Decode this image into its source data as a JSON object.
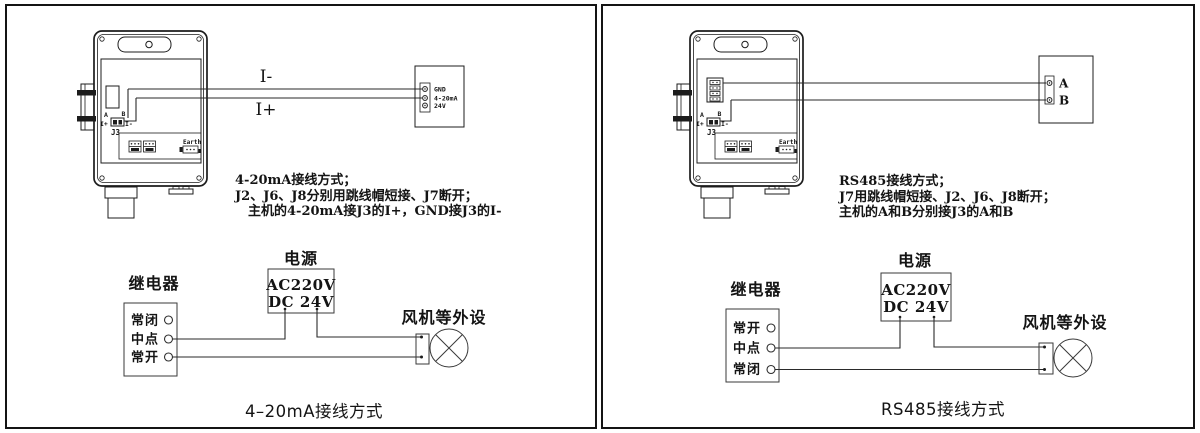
{
  "colors": {
    "line": "#1c1c1c",
    "background": "#ffffff"
  },
  "panels": [
    {
      "name": "4-20mA wiring panel",
      "device": {
        "j3_label": "J3",
        "pin_a": "A",
        "pin_b": "B",
        "pin_iplus": "I+",
        "pin_iminus": "I-",
        "earth_label": "Earth"
      },
      "wires": {
        "top_label": "I-",
        "bottom_label": "I+"
      },
      "host_terminal": {
        "labels": [
          "GND",
          "4-20mA",
          "24V"
        ]
      },
      "note_lines": [
        "4-20mA接线方式；",
        "J2、J6、J8分别用跳线帽短接、J7断开；",
        "主机的4-20mA接J3的I+，GND接J3的I-"
      ],
      "relay": {
        "title": "继电器",
        "terminals": [
          "常闭",
          "中点",
          "常开"
        ]
      },
      "power": {
        "title": "电源",
        "line1": "AC220V",
        "line2": "DC 24V"
      },
      "peripheral": {
        "title": "风机等外设"
      },
      "caption": "4–20mA接线方式"
    },
    {
      "name": "RS485 wiring panel",
      "device": {
        "j3_label": "J3",
        "pin_a": "A",
        "pin_b": "B",
        "pin_iplus": "I+",
        "pin_iminus": "I-",
        "earth_label": "Earth"
      },
      "wires": {
        "top_label": "A",
        "bottom_label": "B"
      },
      "host_terminal": {
        "labels": [
          "A",
          "B"
        ]
      },
      "note_lines": [
        "RS485接线方式；",
        "J7用跳线帽短接、J2、J6、J8断开；",
        "主机的A和B分别接J3的A和B"
      ],
      "relay": {
        "title": "继电器",
        "terminals": [
          "常开",
          "中点",
          "常闭"
        ]
      },
      "power": {
        "title": "电源",
        "line1": "AC220V",
        "line2": "DC 24V"
      },
      "peripheral": {
        "title": "风机等外设"
      },
      "caption": "RS485接线方式"
    }
  ]
}
